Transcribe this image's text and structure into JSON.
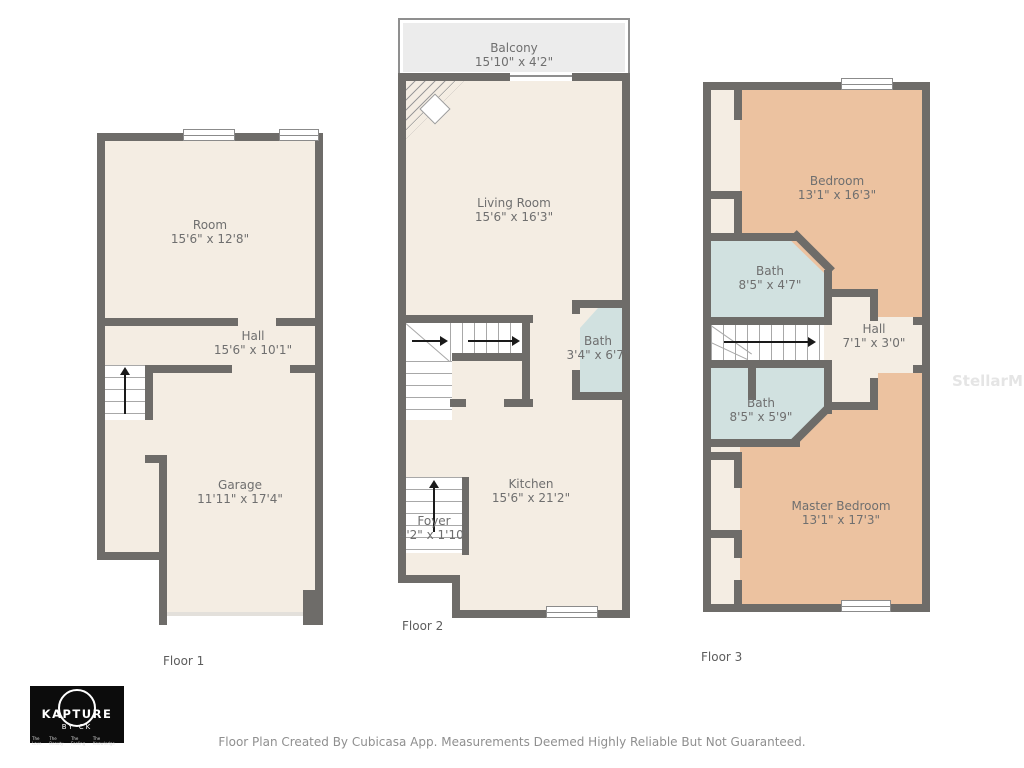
{
  "watermark": "StellarMLS",
  "footer": "Floor Plan Created By Cubicasa App. Measurements Deemed Highly Reliable But Not Guaranteed.",
  "logo": {
    "brand": "KAPTURE",
    "sub": "BY CK",
    "taglines": [
      "The Love",
      "The Beauty",
      "The Feeling",
      "The Knowledge"
    ]
  },
  "colors": {
    "wall": "#6e6c69",
    "floor": "#f4ede3",
    "bedroom": "#ecc2a0",
    "bathroom": "#d1e1e0",
    "balcony": "#ececec"
  },
  "floors": [
    {
      "label": "Floor 1",
      "rooms": [
        {
          "name": "Room",
          "dims": "15'6\" x 12'8\""
        },
        {
          "name": "Hall",
          "dims": "15'6\" x 10'1\""
        },
        {
          "name": "Garage",
          "dims": "11'11\" x 17'4\""
        }
      ]
    },
    {
      "label": "Floor 2",
      "rooms": [
        {
          "name": "Balcony",
          "dims": "15'10\" x 4'2\""
        },
        {
          "name": "Living Room",
          "dims": "15'6\" x 16'3\""
        },
        {
          "name": "Bath",
          "dims": "3'4\" x 6'7\""
        },
        {
          "name": "Kitchen",
          "dims": "15'6\" x 21'2\""
        },
        {
          "name": "Foyer",
          "dims": "4'2\" x 1'10\""
        }
      ]
    },
    {
      "label": "Floor 3",
      "rooms": [
        {
          "name": "Bedroom",
          "dims": "13'1\" x 16'3\""
        },
        {
          "name": "Bath",
          "dims": "8'5\" x 4'7\""
        },
        {
          "name": "Hall",
          "dims": "7'1\" x 3'0\""
        },
        {
          "name": "Bath",
          "dims": "8'5\" x 5'9\""
        },
        {
          "name": "Master Bedroom",
          "dims": "13'1\" x 17'3\""
        }
      ]
    }
  ]
}
